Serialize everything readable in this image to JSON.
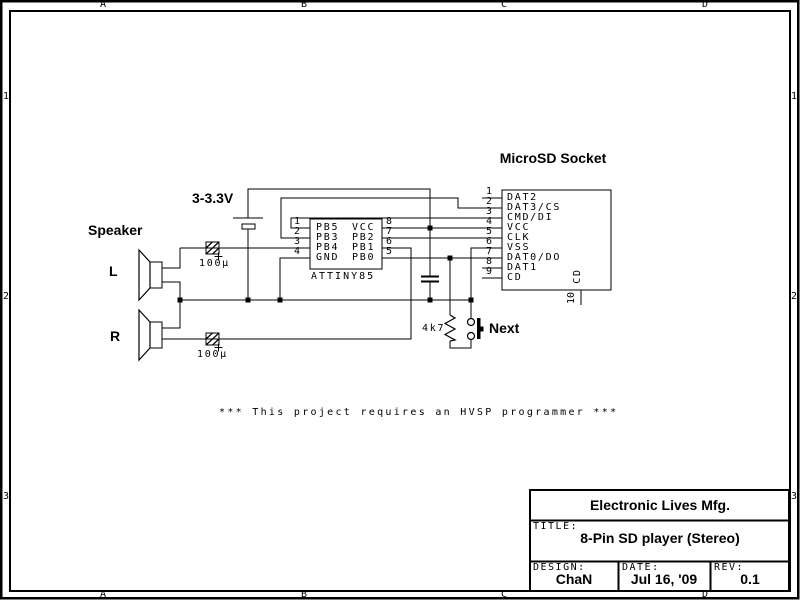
{
  "sheet": {
    "zones_top": [
      "A",
      "B",
      "C",
      "D"
    ],
    "zones_bottom": [
      "A",
      "B",
      "C",
      "D"
    ],
    "zones_left": [
      "1",
      "2",
      "3"
    ],
    "zones_right": [
      "1",
      "2",
      "3"
    ]
  },
  "labels": {
    "supply_voltage": "3-3.3V",
    "speaker_group": "Speaker",
    "speaker_left": "L",
    "speaker_right": "R",
    "cap_left_value": "100μ",
    "cap_right_value": "100μ",
    "resistor_value": "4k7",
    "button_label": "Next",
    "socket_title": "MicroSD Socket",
    "note": "*** This project requires an HVSP programmer ***"
  },
  "chip": {
    "name": "ATTINY85",
    "left_pins": [
      {
        "num": "1",
        "name": "PB5"
      },
      {
        "num": "2",
        "name": "PB3"
      },
      {
        "num": "3",
        "name": "PB4"
      },
      {
        "num": "4",
        "name": "GND"
      }
    ],
    "right_pins": [
      {
        "num": "8",
        "name": "VCC"
      },
      {
        "num": "7",
        "name": "PB2"
      },
      {
        "num": "6",
        "name": "PB1"
      },
      {
        "num": "5",
        "name": "PB0"
      }
    ]
  },
  "socket": {
    "pins": [
      {
        "num": "1",
        "name": "DAT2"
      },
      {
        "num": "2",
        "name": "DAT3/CS"
      },
      {
        "num": "3",
        "name": "CMD/DI"
      },
      {
        "num": "4",
        "name": "VCC"
      },
      {
        "num": "5",
        "name": "CLK"
      },
      {
        "num": "6",
        "name": "VSS"
      },
      {
        "num": "7",
        "name": "DAT0/DO"
      },
      {
        "num": "8",
        "name": "DAT1"
      },
      {
        "num": "9",
        "name": "CD"
      }
    ],
    "bottom_pin": {
      "num": "10",
      "name": "CD"
    }
  },
  "title_block": {
    "company": "Electronic Lives Mfg.",
    "title_label": "TITLE:",
    "title": "8-Pin SD player (Stereo)",
    "design_label": "DESIGN:",
    "design_value": "ChaN",
    "date_label": "DATE:",
    "date_value": "Jul 16, '09",
    "rev_label": "REV:",
    "rev_value": "0.1"
  },
  "colors": {
    "ink": "#000000",
    "paper": "#ffffff"
  }
}
